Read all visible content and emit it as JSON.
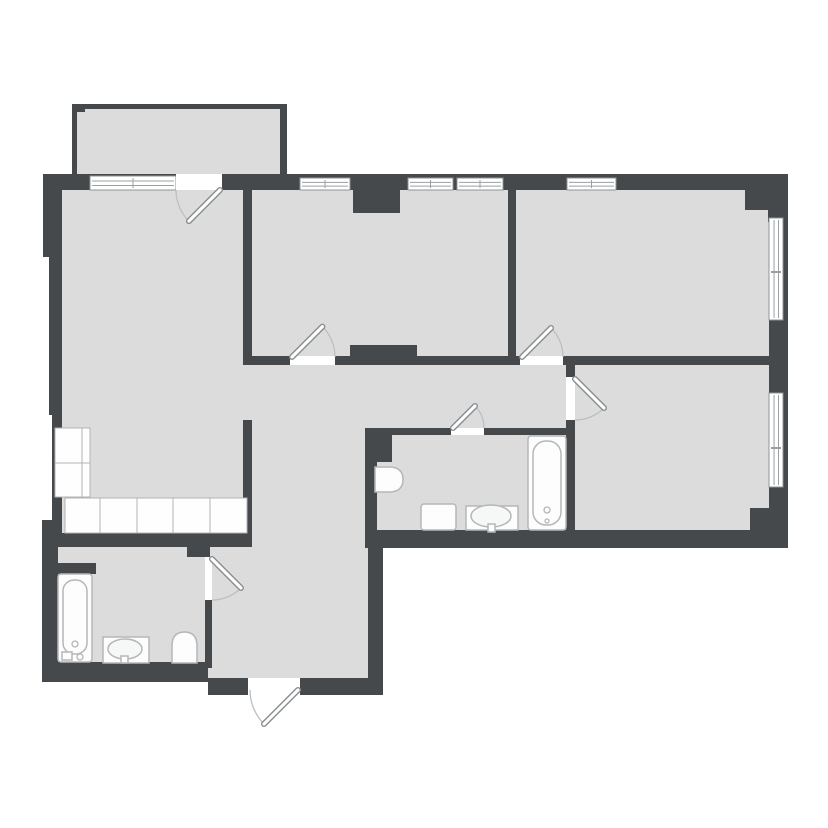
{
  "canvas": {
    "w": 828,
    "h": 828
  },
  "colors": {
    "bg": "#ffffff",
    "floor": "#dcdcdd",
    "wall": "#45494b",
    "window_frame": "#8f9597",
    "window_line": "#9aa0a2",
    "fixture_fill": "#fdfdfd",
    "fixture_stroke": "#b3b7b9",
    "bowl_fill": "#f6f7f7",
    "cell_stroke": "#b0b4b6",
    "cell_fill": "#fefefe",
    "door_edge": "#878d90",
    "door_fill": "#ffffff",
    "arc": "#bcc0c2"
  },
  "floors": [
    {
      "name": "balcony-floor",
      "r": [
        77,
        109,
        203,
        81
      ]
    },
    {
      "name": "main-floor",
      "r": [
        52,
        174,
        736,
        374
      ]
    },
    {
      "name": "lower-left-floor",
      "r": [
        44,
        520,
        339,
        175
      ]
    }
  ],
  "carves": [
    {
      "name": "exterior-notch",
      "r": [
        40,
        682,
        168,
        20
      ]
    }
  ],
  "walls": [
    {
      "name": "balcony-wall-left",
      "r": [
        72,
        104,
        5,
        86
      ]
    },
    {
      "name": "balcony-wall-top",
      "r": [
        72,
        104,
        215,
        5
      ]
    },
    {
      "name": "balcony-wall-corner",
      "r": [
        72,
        104,
        13,
        8
      ]
    },
    {
      "name": "balcony-wall-right",
      "r": [
        280,
        104,
        7,
        70
      ]
    },
    {
      "name": "top-wall-corner-left",
      "r": [
        43,
        174,
        47,
        16
      ]
    },
    {
      "name": "left-wall-upper",
      "r": [
        43,
        174,
        19,
        83
      ]
    },
    {
      "name": "left-wall-mid",
      "r": [
        49,
        257,
        13,
        158
      ]
    },
    {
      "name": "left-wall-lower",
      "r": [
        52,
        415,
        10,
        118
      ]
    },
    {
      "name": "left-wall-bottom",
      "r": [
        42,
        520,
        16,
        145
      ]
    },
    {
      "name": "top-wall-seg2",
      "r": [
        222,
        174,
        78,
        16
      ]
    },
    {
      "name": "top-window-ledge-a",
      "r": [
        43,
        174,
        133,
        4
      ]
    },
    {
      "name": "top-window-ledge-b",
      "r": [
        222,
        174,
        394,
        4
      ]
    },
    {
      "name": "top-wall-pier",
      "r": [
        350,
        174,
        58,
        16
      ]
    },
    {
      "name": "pier-stub-top",
      "r": [
        353,
        190,
        47,
        23
      ]
    },
    {
      "name": "top-window-mullion",
      "r": [
        453,
        174,
        4,
        16
      ]
    },
    {
      "name": "top-wall-seg3",
      "r": [
        503,
        174,
        64,
        16
      ]
    },
    {
      "name": "top-wall-seg4",
      "r": [
        616,
        174,
        172,
        16
      ]
    },
    {
      "name": "right-corner-block",
      "r": [
        745,
        174,
        43,
        36
      ]
    },
    {
      "name": "right-step-top",
      "r": [
        768,
        210,
        20,
        12
      ]
    },
    {
      "name": "right-outer-edge",
      "r": [
        783,
        210,
        5,
        323
      ]
    },
    {
      "name": "right-wall-mid",
      "r": [
        769,
        320,
        19,
        73
      ]
    },
    {
      "name": "right-wall-low",
      "r": [
        769,
        487,
        19,
        21
      ]
    },
    {
      "name": "right-step-bottom",
      "r": [
        750,
        508,
        38,
        25
      ]
    },
    {
      "name": "bottom-band",
      "r": [
        365,
        530,
        423,
        18
      ]
    },
    {
      "name": "livingroom-right-wall-upper",
      "r": [
        243,
        190,
        9,
        175
      ]
    },
    {
      "name": "livingroom-right-wall-lower",
      "r": [
        243,
        420,
        9,
        113
      ]
    },
    {
      "name": "bedrooms-divider-wall",
      "r": [
        508,
        190,
        8,
        175
      ]
    },
    {
      "name": "hallway-top-wall-a",
      "r": [
        243,
        356,
        47,
        9
      ]
    },
    {
      "name": "hallway-top-wall-b",
      "r": [
        335,
        356,
        185,
        9
      ]
    },
    {
      "name": "hallway-top-wall-c",
      "r": [
        563,
        356,
        207,
        9
      ]
    },
    {
      "name": "pier-stub-bottom",
      "r": [
        350,
        345,
        67,
        11
      ]
    },
    {
      "name": "bedroom3-left-wall-top",
      "r": [
        566,
        365,
        9,
        12
      ]
    },
    {
      "name": "bedroom3-left-wall-bottom",
      "r": [
        566,
        420,
        9,
        110
      ]
    },
    {
      "name": "bathroom-left-block",
      "r": [
        365,
        428,
        27,
        34
      ]
    },
    {
      "name": "bathroom-left-wall",
      "r": [
        365,
        462,
        12,
        68
      ]
    },
    {
      "name": "bathroom-top-wall-a",
      "r": [
        392,
        428,
        59,
        7
      ]
    },
    {
      "name": "bathroom-top-wall-b",
      "r": [
        484,
        428,
        82,
        7
      ]
    },
    {
      "name": "livingroom-bottom-wall",
      "r": [
        43,
        533,
        209,
        14
      ]
    },
    {
      "name": "wc-corner-stub",
      "r": [
        187,
        533,
        23,
        24
      ]
    },
    {
      "name": "wc-top-wall",
      "r": [
        42,
        563,
        54,
        11
      ]
    },
    {
      "name": "wc-right-wall",
      "r": [
        205,
        600,
        7,
        68
      ]
    },
    {
      "name": "wc-bottom-wall",
      "r": [
        42,
        662,
        166,
        20
      ]
    },
    {
      "name": "corridor-bottom-wall-a",
      "r": [
        208,
        678,
        40,
        17
      ]
    },
    {
      "name": "corridor-bottom-wall-b",
      "r": [
        300,
        678,
        83,
        17
      ]
    },
    {
      "name": "corridor-right-wall",
      "r": [
        368,
        535,
        15,
        160
      ]
    }
  ],
  "windows": [
    {
      "name": "window-livingroom-balcony",
      "r": [
        90,
        176,
        86,
        14
      ],
      "orient": "h"
    },
    {
      "name": "window-bedroom1-a",
      "r": [
        300,
        178,
        50,
        12
      ],
      "orient": "h"
    },
    {
      "name": "window-bedroom1-b",
      "r": [
        408,
        178,
        45,
        12
      ],
      "orient": "h"
    },
    {
      "name": "window-bedroom1-c",
      "r": [
        457,
        178,
        46,
        12
      ],
      "orient": "h"
    },
    {
      "name": "window-bedroom2-top",
      "r": [
        567,
        178,
        49,
        12
      ],
      "orient": "h"
    },
    {
      "name": "window-bedroom2-right",
      "r": [
        769,
        218,
        14,
        102
      ],
      "orient": "v",
      "mullion": 272
    },
    {
      "name": "window-bedroom3-right",
      "r": [
        769,
        393,
        14,
        94
      ],
      "orient": "v",
      "mullion": 448
    }
  ],
  "openings": [
    {
      "name": "balcony-door-opening",
      "r": [
        176,
        174,
        46,
        16
      ]
    },
    {
      "name": "bedroom1-door-opening",
      "r": [
        290,
        356,
        45,
        9
      ]
    },
    {
      "name": "bedroom2-door-opening",
      "r": [
        520,
        356,
        43,
        9
      ]
    },
    {
      "name": "bedroom3-door-opening",
      "r": [
        566,
        377,
        9,
        43
      ]
    },
    {
      "name": "bathroom-door-opening",
      "r": [
        451,
        428,
        33,
        7
      ]
    },
    {
      "name": "wc-door-opening",
      "r": [
        205,
        557,
        7,
        43
      ]
    },
    {
      "name": "entrance-door-opening",
      "r": [
        248,
        678,
        52,
        17
      ]
    }
  ],
  "doors": [
    {
      "name": "balcony-door",
      "leaf": [
        220,
        190,
        188.9,
        221.1
      ],
      "arc": "M176,190 A44,44 0 0 0 188.9,221.1"
    },
    {
      "name": "bedroom1-door",
      "leaf": [
        292,
        357,
        322.4,
        326.6
      ],
      "arc": "M335,357 A43,43 0 0 0 322.4,326.6"
    },
    {
      "name": "bedroom2-door",
      "leaf": [
        522,
        357,
        551,
        328
      ],
      "arc": "M563,357 A41,41 0 0 0 551,328"
    },
    {
      "name": "bedroom3-door",
      "leaf": [
        575,
        379,
        604,
        408
      ],
      "arc": "M575,420 A41,41 0 0 0 604,408"
    },
    {
      "name": "bathroom-door",
      "leaf": [
        453,
        428,
        475,
        406
      ],
      "arc": "M484,428 A31,31 0 0 0 475,406"
    },
    {
      "name": "wc-door",
      "leaf": [
        212,
        559,
        241,
        588
      ],
      "arc": "M212,600 A41,41 0 0 0 241,588"
    },
    {
      "name": "entrance-door",
      "leaf": [
        298,
        690,
        264,
        724
      ],
      "arc": "M250,690 A48,48 0 0 0 264,724"
    }
  ],
  "fixtures": [
    {
      "name": "kitchen-cabinet",
      "kind": "cell",
      "r": [
        55,
        428,
        35,
        35
      ]
    },
    {
      "name": "kitchen-cabinet",
      "kind": "cell",
      "r": [
        55,
        463,
        35,
        34
      ]
    },
    {
      "name": "kitchen-cabinet-divider",
      "kind": "line",
      "p": [
        82,
        428,
        82,
        497
      ]
    },
    {
      "name": "kitchen-counter-cell",
      "kind": "cell",
      "r": [
        65,
        498,
        35,
        35
      ]
    },
    {
      "name": "kitchen-counter-cell",
      "kind": "cell",
      "r": [
        100,
        498,
        37,
        35
      ]
    },
    {
      "name": "kitchen-counter-cell",
      "kind": "cell",
      "r": [
        137,
        498,
        36,
        35
      ]
    },
    {
      "name": "kitchen-counter-cell",
      "kind": "cell",
      "r": [
        173,
        498,
        37,
        35
      ]
    },
    {
      "name": "kitchen-counter-cell",
      "kind": "cell",
      "r": [
        210,
        498,
        37,
        35
      ]
    },
    {
      "name": "bathtub",
      "kind": "rect",
      "r": [
        58,
        574,
        34,
        88
      ],
      "rx": 3
    },
    {
      "name": "bathtub-inner",
      "kind": "rect",
      "r": [
        63,
        580,
        24,
        74
      ],
      "rx": 11
    },
    {
      "name": "bathtub-drain",
      "kind": "circle",
      "c": [
        75,
        644,
        3
      ]
    },
    {
      "name": "bathtub-faucet",
      "kind": "rect",
      "r": [
        62,
        652,
        10,
        8
      ]
    },
    {
      "name": "bathtub-faucet",
      "kind": "circle",
      "c": [
        80,
        657,
        3
      ]
    },
    {
      "name": "sink",
      "kind": "rect",
      "r": [
        103,
        637,
        46,
        26
      ]
    },
    {
      "name": "sink-bowl",
      "kind": "bowl",
      "e": [
        125,
        649,
        17,
        10
      ]
    },
    {
      "name": "sink-faucet",
      "kind": "rect",
      "r": [
        121,
        656,
        7,
        7
      ]
    },
    {
      "name": "toilet",
      "kind": "path",
      "d": "M172,663 L172,646 Q172,632 184.5,632 Q197,632 197,646 L197,663 Z"
    },
    {
      "name": "washing-machine",
      "kind": "rect",
      "r": [
        421,
        504,
        35,
        26
      ],
      "rx": 3
    },
    {
      "name": "sink",
      "kind": "rect",
      "r": [
        466,
        506,
        52,
        24
      ]
    },
    {
      "name": "sink-bowl",
      "kind": "bowl",
      "e": [
        491,
        516,
        20,
        11
      ]
    },
    {
      "name": "sink-faucet",
      "kind": "rect",
      "r": [
        488,
        524,
        7,
        8
      ]
    },
    {
      "name": "toilet",
      "kind": "path",
      "d": "M375,467 L389,467 Q403,467 403,479.5 Q403,492 389,492 L375,492 Z"
    },
    {
      "name": "bathtub",
      "kind": "rect",
      "r": [
        528,
        436,
        38,
        94
      ],
      "rx": 3
    },
    {
      "name": "bathtub-inner",
      "kind": "rect",
      "r": [
        533,
        441,
        28,
        84
      ],
      "rx": 13
    },
    {
      "name": "bathtub-drain",
      "kind": "circle",
      "c": [
        547,
        510,
        3
      ]
    },
    {
      "name": "bathtub-drain",
      "kind": "circle",
      "c": [
        547,
        521,
        2
      ]
    }
  ]
}
